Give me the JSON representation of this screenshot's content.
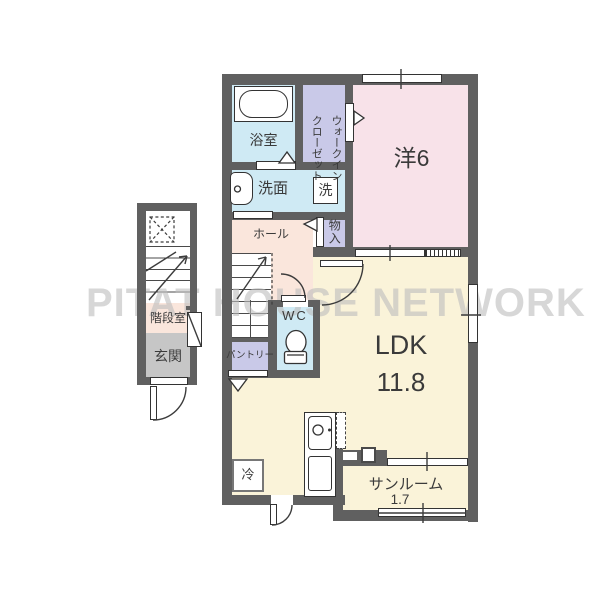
{
  "watermark": "PITAT HOUSE NETWORK",
  "rooms": {
    "bathroom": {
      "label": "浴室"
    },
    "walk_in_closet": {
      "line1": "ウォークイン",
      "line2": "クローゼット"
    },
    "washroom": {
      "label": "洗面"
    },
    "washer": {
      "label": "洗"
    },
    "western_room": {
      "label": "洋6"
    },
    "storage": {
      "label": "物入"
    },
    "hall": {
      "label": "ホール"
    },
    "wc": {
      "label": "WC"
    },
    "pantry": {
      "label": "パントリー"
    },
    "stair_room": {
      "label": "階段室"
    },
    "entrance": {
      "label": "玄関"
    },
    "ldk": {
      "label": "LDK",
      "size": "11.8"
    },
    "refrigerator": {
      "label": "冷"
    },
    "sunroom": {
      "label": "サンルーム",
      "size": "1.7"
    }
  },
  "colors": {
    "wall": "#606060",
    "water": "#cfeaf4",
    "closet": "#c9c9e8",
    "bedroom": "#f8e2e9",
    "hallc": "#fae6dc",
    "living": "#faf3d9",
    "entrancec": "#c6c6c6",
    "ink": "#3a3a3a",
    "wmc": "#bdbdbd"
  }
}
